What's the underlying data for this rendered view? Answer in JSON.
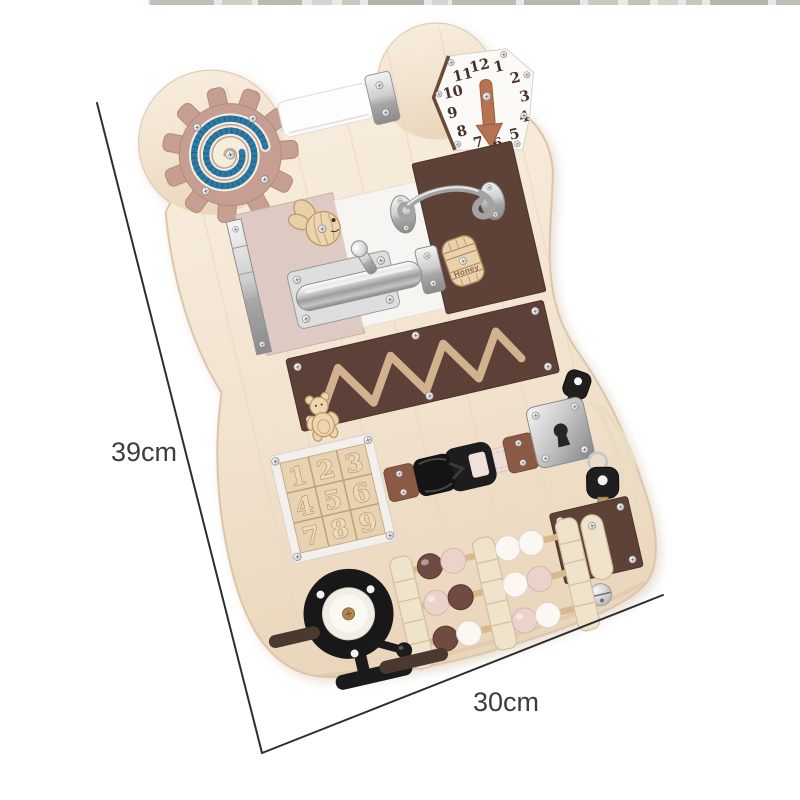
{
  "annotations": {
    "height_label": "39cm",
    "width_label": "30cm"
  },
  "board": {
    "clock": {
      "numbers": [
        "12",
        "1",
        "2",
        "3",
        "4",
        "5",
        "6",
        "7",
        "8",
        "9",
        "10",
        "11"
      ]
    },
    "puzzle": {
      "tiles": [
        "1",
        "2",
        "3",
        "4",
        "5",
        "6",
        "7",
        "8",
        "9"
      ]
    },
    "honey_barrel": {
      "label": "Honey"
    }
  },
  "colors": {
    "board_wood": "#f3e6d5",
    "gear_rose": "#c79f92",
    "glitter_blue": "#2d7aa5",
    "chocolate_brown": "#5e4137",
    "door_pink": "#dccac3",
    "bead_pink": "#ebd3cb",
    "bead_brown": "#6f4b43",
    "metal_silver": "#c9c9c9",
    "annotation_text": "#3d3d3d"
  }
}
